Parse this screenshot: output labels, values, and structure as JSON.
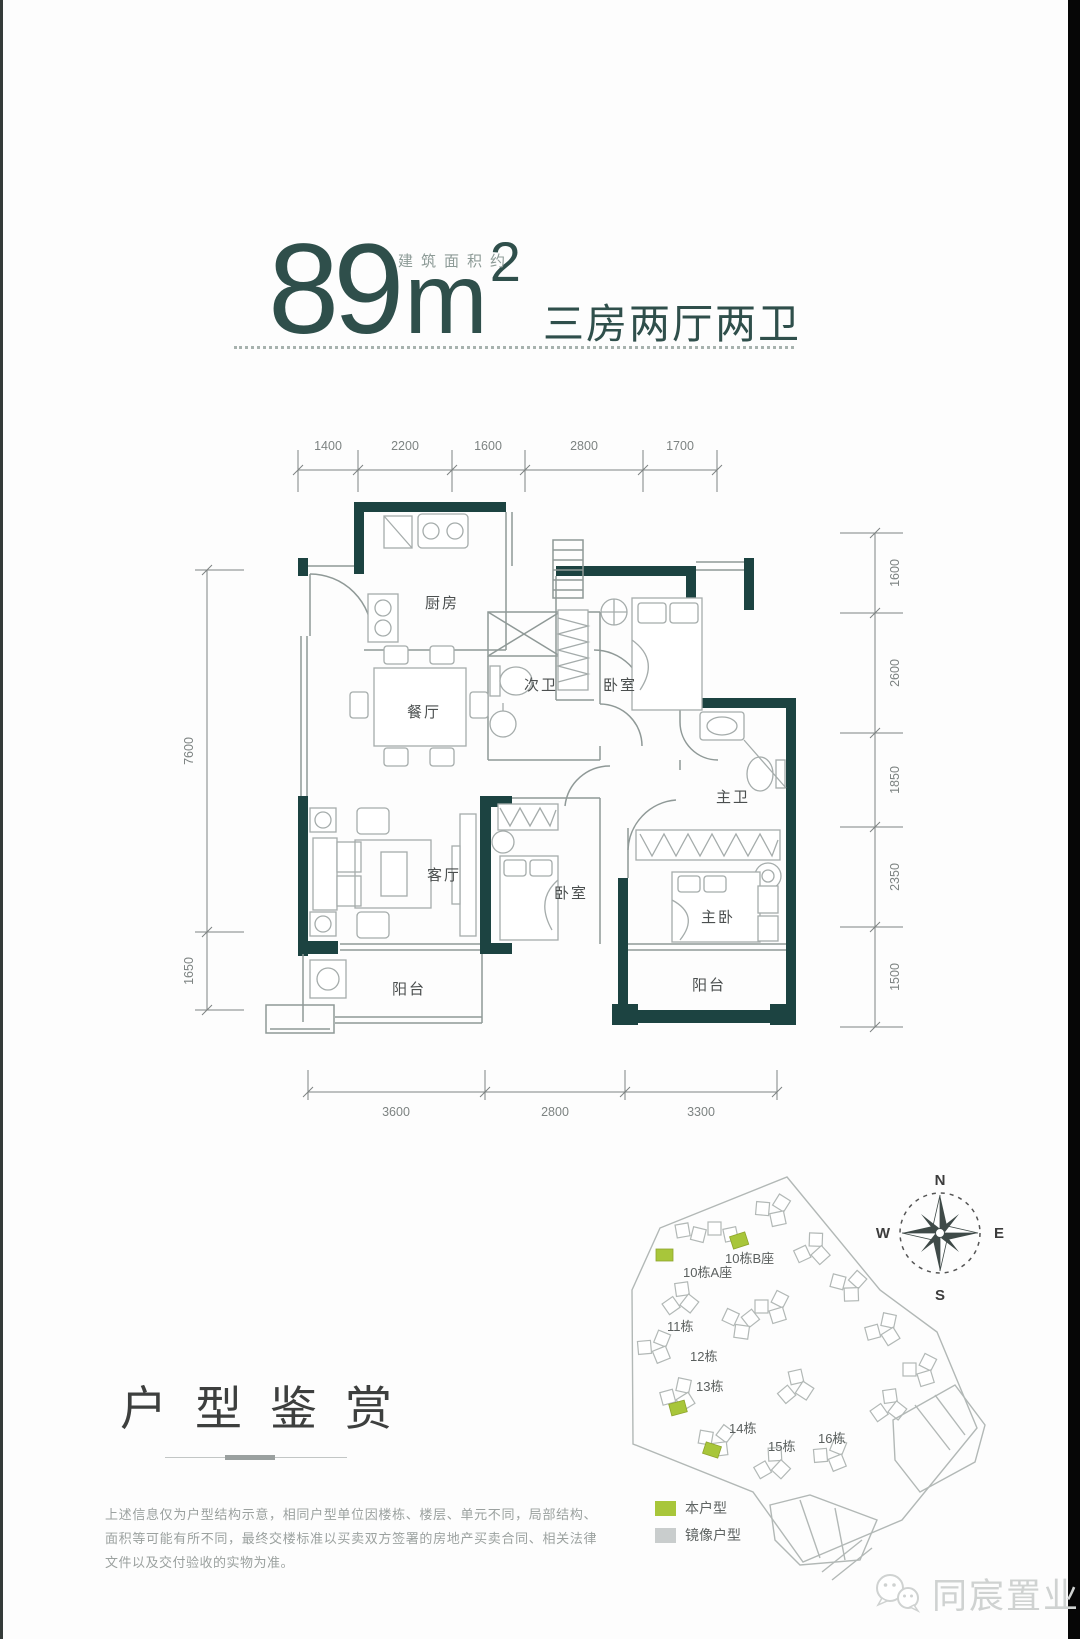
{
  "title": {
    "area_note": "建筑面积约",
    "area_value": "89",
    "area_unit": "m",
    "area_exp": "2",
    "layout_desc": "三房两厅两卫"
  },
  "floorplan": {
    "rooms": {
      "kitchen": "厨房",
      "dining": "餐厅",
      "second_bath": "次卫",
      "bedroom_top": "卧室",
      "living": "客厅",
      "bedroom_mid": "卧室",
      "master_bath": "主卫",
      "master_bedroom": "主卧",
      "balcony_right": "阳台",
      "balcony_left": "阳台"
    },
    "dims_top": [
      "1400",
      "2200",
      "1600",
      "2800",
      "1700"
    ],
    "dims_bottom": [
      "3600",
      "2800",
      "3300"
    ],
    "dims_left": [
      "7600",
      "1650"
    ],
    "dims_right": [
      "1600",
      "2600",
      "1850",
      "2350",
      "1500"
    ]
  },
  "section_heading": "户型鉴赏",
  "sitemap": {
    "buildings": [
      "10栋B座",
      "10栋A座",
      "11栋",
      "12栋",
      "13栋",
      "14栋",
      "15栋",
      "16栋"
    ],
    "legend": [
      {
        "label": "本户型",
        "color": "#a8c63a"
      },
      {
        "label": "镜像户型",
        "color": "#c9cdcd"
      }
    ],
    "compass": {
      "n": "N",
      "s": "S",
      "e": "E",
      "w": "W"
    }
  },
  "disclaimer": "上述信息仅为户型结构示意，相同户型单位因楼栋、楼层、单元不同，局部结构、面积等可能有所不同，最终交楼标准以买卖双方签署的房地产买卖合同、相关法律文件以及交付验收的实物为准。",
  "watermark": "同宸置业",
  "colors": {
    "accent_teal": "#2f4f4b",
    "wall_teal": "#1c4341",
    "highlight_green": "#a8c63a",
    "mirror_gray": "#c9cdcd"
  }
}
